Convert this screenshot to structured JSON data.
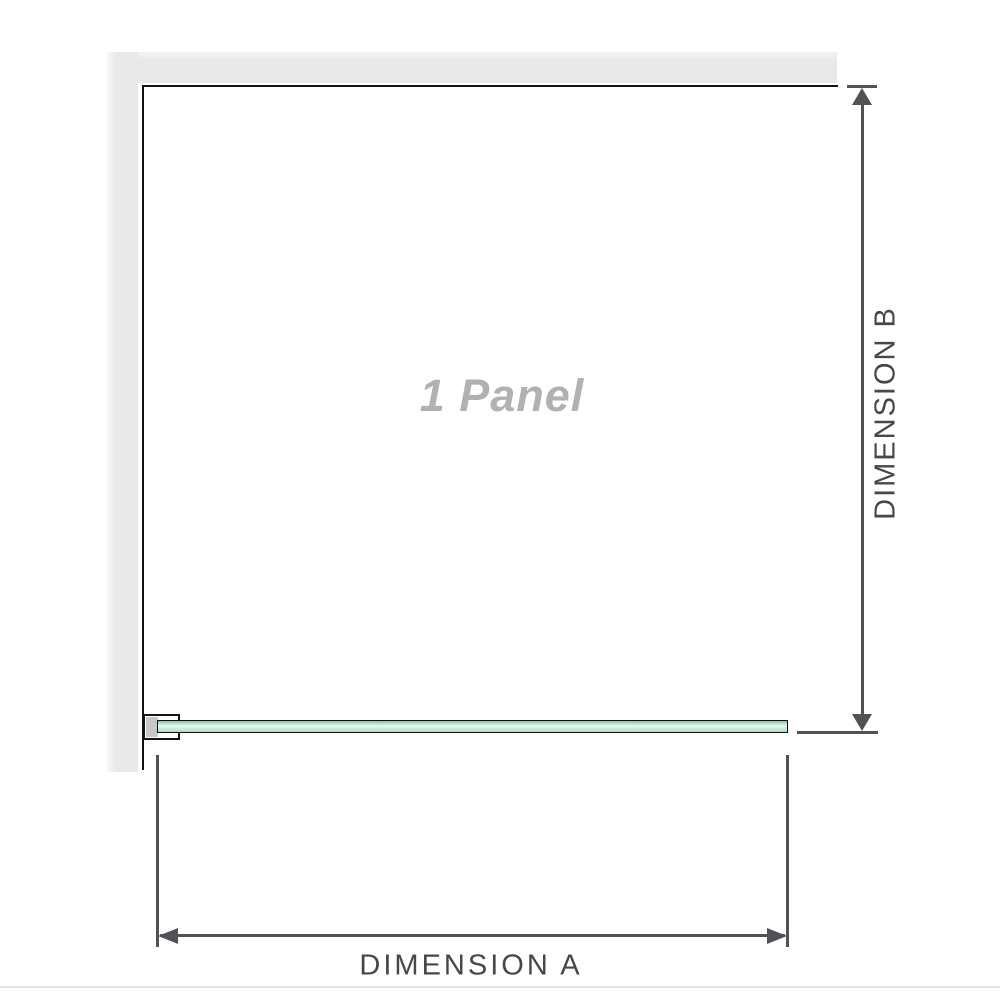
{
  "diagram": {
    "panel_label": "1 Panel",
    "dimension_a_label": "DIMENSION A",
    "dimension_b_label": "DIMENSION B"
  },
  "colors": {
    "wall_fill": "#e9e9e9",
    "frame_outline": "#141414",
    "bracket_pad": "#c8c8c8",
    "glass_green": "#a9dcc3",
    "glass_highlight": "#e9f8f0",
    "dimension_line": "#515256",
    "dimension_text": "#46474b",
    "panel_label_text": "#b1b1b1",
    "footer_divider": "#e7e3da"
  }
}
